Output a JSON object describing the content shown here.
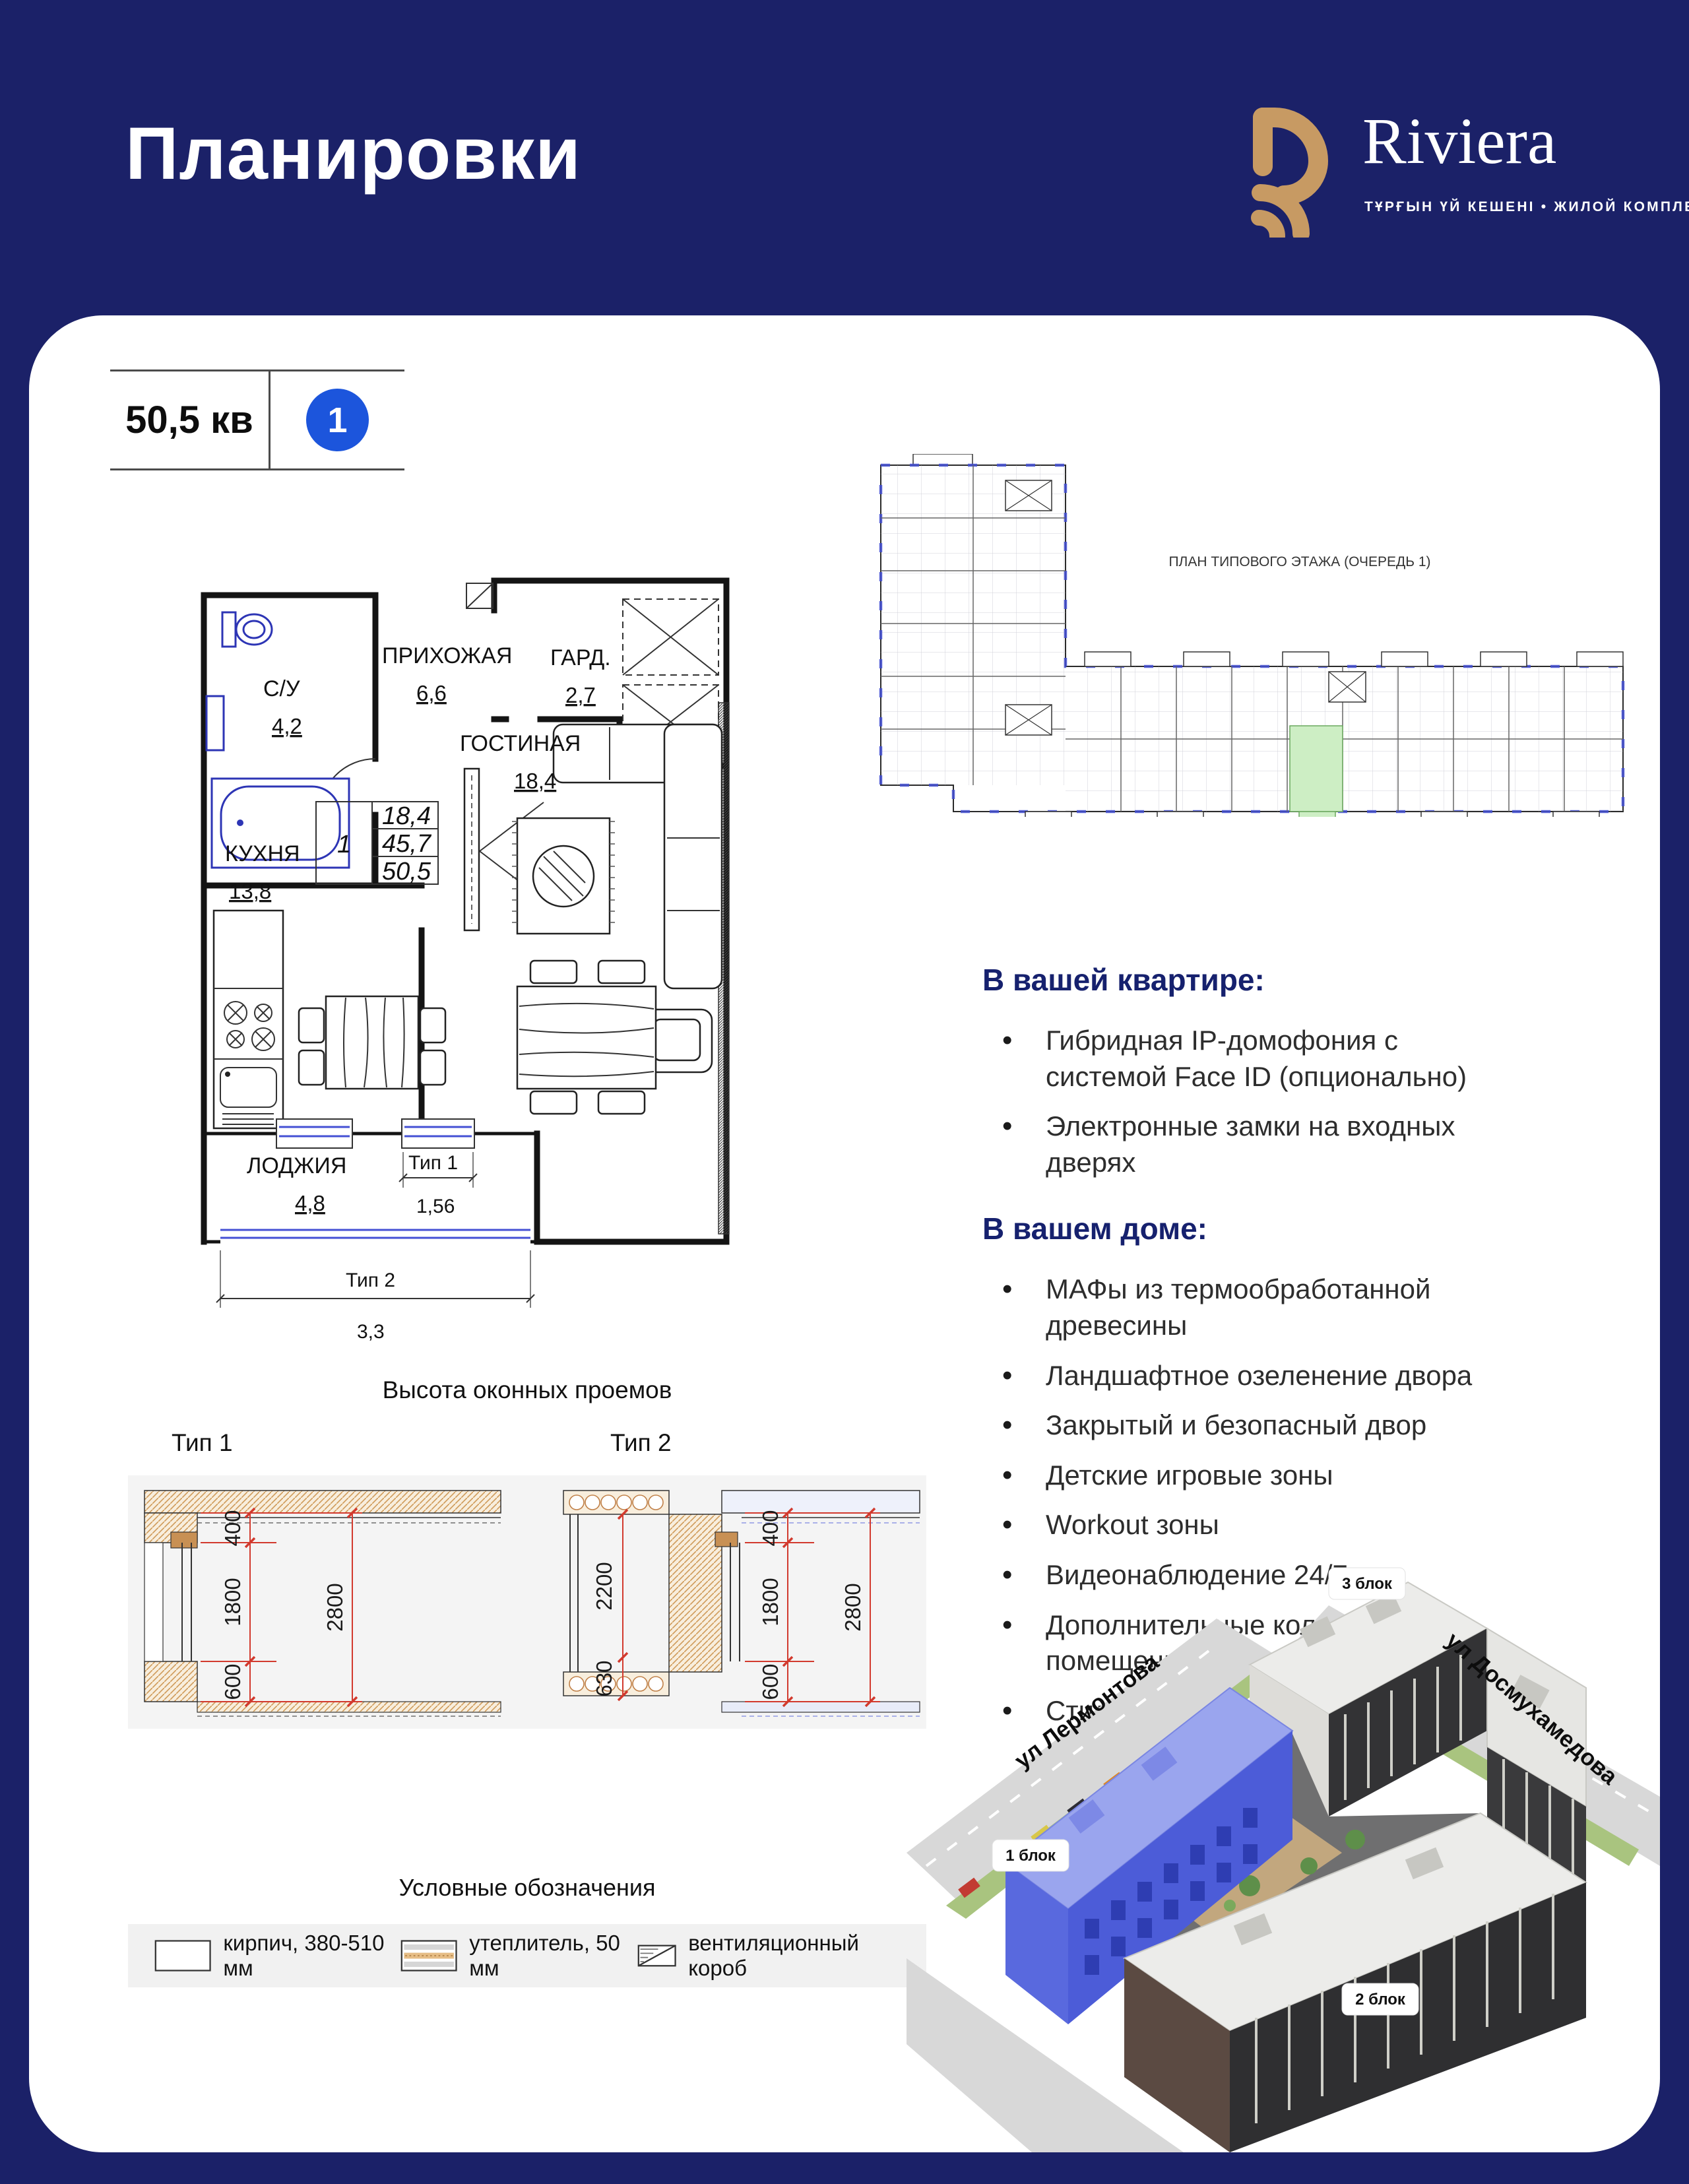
{
  "header": {
    "title": "Планировки",
    "brand": "Riviera",
    "tagline": "ТҰРҒЫН ҮЙ КЕШЕНІ • ЖИЛОЙ КОМПЛЕКС"
  },
  "unit": {
    "area": "50,5 кв",
    "number": "1"
  },
  "floor_plan": {
    "rooms": [
      {
        "name": "С/У",
        "area": "4,2"
      },
      {
        "name": "ПРИХОЖАЯ",
        "area": "6,6"
      },
      {
        "name": "ГАРД.",
        "area": "2,7"
      },
      {
        "name": "ГОСТИНАЯ",
        "area": "18,4"
      },
      {
        "name": "КУХНЯ",
        "area": "13,8"
      },
      {
        "name": "ЛОДЖИЯ",
        "area": "4,8"
      }
    ],
    "stat_table": {
      "rooms": "1",
      "living": "18,4",
      "sub": "45,7",
      "total": "50,5"
    },
    "window_marks": [
      {
        "label": "Тип 1",
        "width": "1,56"
      },
      {
        "label": "Тип 2",
        "width": "3,3"
      }
    ]
  },
  "site_plan": {
    "caption": "ПЛАН ТИПОВОГО ЭТАЖА (ОЧЕРЕДЬ 1)"
  },
  "apartment": {
    "heading": "В вашей квартире:",
    "items": [
      "Гибридная IP-домофония с системой Face ID (опционально)",
      "Электронные замки на входных дверях"
    ]
  },
  "house": {
    "heading": "В вашем доме:",
    "items": [
      "МАФы из термообработанной древесины",
      "Ландшафтное озеленение двора",
      "Закрытый и безопасный двор",
      "Детские игровые зоны",
      "Workout зоны",
      "Видеонаблюдение 24/7",
      "Дополнительные колясочные помещения",
      "Стильный дизайн холлов"
    ]
  },
  "windows": {
    "title": "Высота оконных проемов",
    "types": [
      {
        "label": "Тип 1",
        "dims": {
          "top": "400",
          "mid": "1800",
          "bottom": "600",
          "full": "2800"
        }
      },
      {
        "label": "Тип 2",
        "dims": {
          "left_mid": "2200",
          "left_bottom": "630",
          "top": "400",
          "mid": "1800",
          "bottom": "600",
          "full": "2800"
        }
      }
    ]
  },
  "legend": {
    "title": "Условные обозначения",
    "items": [
      "кирпич, 380-510 мм",
      "утеплитель, 50 мм",
      "вентиляционный короб"
    ]
  },
  "render": {
    "streets": [
      "ул Лермонтова",
      "ул Досмухамедова"
    ],
    "blocks": [
      "1 блок",
      "2 блок",
      "3 блок"
    ]
  },
  "colors": {
    "navy": "#1B2168",
    "gold": "#C79A63",
    "accent_blue": "#1C55DC",
    "plan_blue": "#4450D4",
    "dim_red": "#D23A2E",
    "highlight_green": "#CDEEC4"
  }
}
